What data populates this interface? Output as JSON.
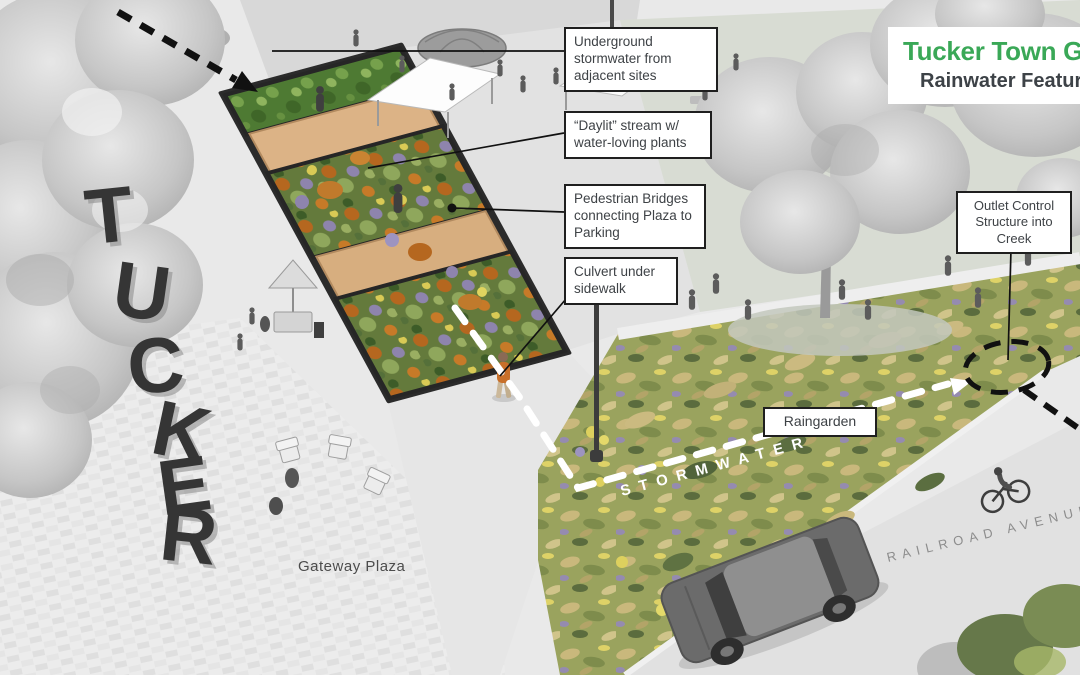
{
  "title_card": {
    "title": "Tucker Town Green",
    "subtitle": "Rainwater Features"
  },
  "callouts": {
    "underground": "Underground stormwater from adjacent sites",
    "daylit": "“Daylit” stream w/ water-loving plants",
    "bridges": "Pedestrian Bridges connecting Plaza to Parking",
    "culvert": "Culvert under sidewalk",
    "outlet": "Outlet Control Structure into Creek",
    "raingarden": "Raingarden"
  },
  "labels": {
    "gateway_plaza": "Gateway Plaza",
    "street": "RAILROAD AVENUE",
    "flow": "STORMWATER"
  },
  "sculpture": {
    "letters": [
      "T",
      "U",
      "C",
      "K",
      "E",
      "R"
    ]
  },
  "colors": {
    "accent_green": "#3aa857",
    "subtitle_gray": "#3d4247",
    "callout_border": "#1f1f1f",
    "bridge_tan": "#d9b183",
    "flow_arrow_white": "#ffffff",
    "annotation_black": "#111111"
  }
}
